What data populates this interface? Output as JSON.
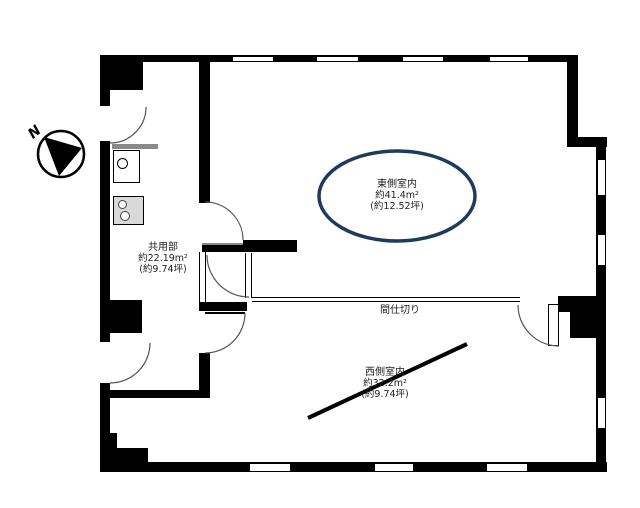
{
  "plan": {
    "compass_label": "N",
    "rooms": {
      "east": {
        "name": "東側室内",
        "area_m2": "約41.4m²",
        "area_tsubo": "(約12.52坪)"
      },
      "west": {
        "name": "西側室内",
        "area_m2": "約32.2m²",
        "area_tsubo": "(約9.74坪)"
      },
      "common": {
        "name": "共用部",
        "area_m2": "約22.19m²",
        "area_tsubo": "(約9.74坪)"
      }
    },
    "partition_label": "間仕切り",
    "colors": {
      "wall": "#000000",
      "ellipse_stroke": "#1e3a5c",
      "counter_gray": "#8a8a8a",
      "stove_fill": "#d9d9d9"
    }
  }
}
